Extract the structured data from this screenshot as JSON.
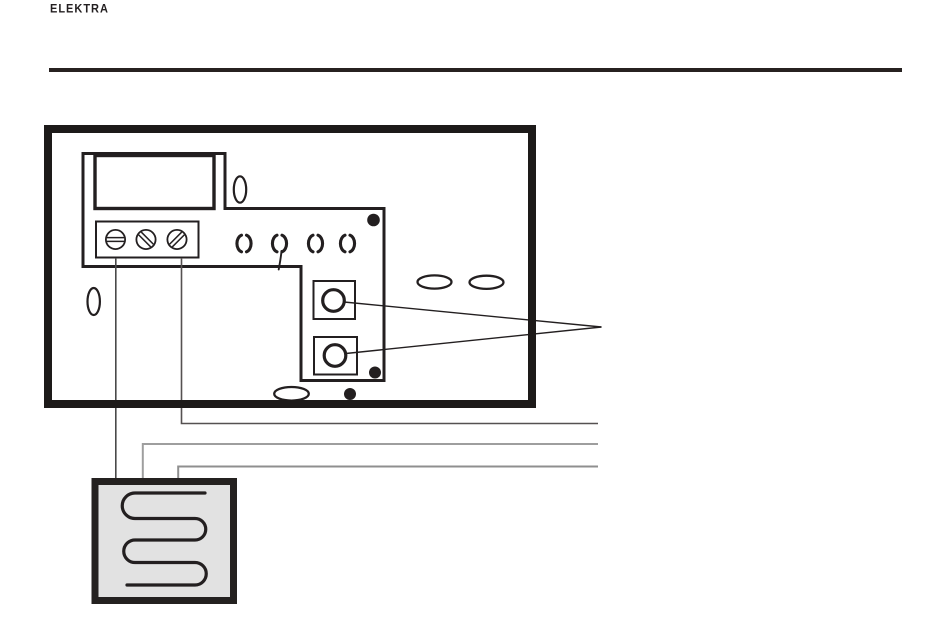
{
  "header": {
    "logo_text": "ELEKTRA"
  },
  "colors": {
    "ink": "#231f20",
    "wire_dark": "#4a4a4a",
    "wire_dark2": "#555151",
    "wire_gray": "#9e9e9e",
    "wire_gray2": "#8f8f8f",
    "mat_fill": "#e2e2e2",
    "rule": "#272120"
  },
  "diagram": {
    "icon_names": [
      "thermostat-housing",
      "mounting-plate-outline",
      "display-window",
      "terminal-block",
      "screw-terminal-icon",
      "cable-clip-icon",
      "fixing-hole-oval-icon",
      "screw-dot-icon",
      "sensor-terminal-icon",
      "callout-lines",
      "supply-wires",
      "heating-mat-icon",
      "heating-cable-serpentine-icon"
    ]
  }
}
